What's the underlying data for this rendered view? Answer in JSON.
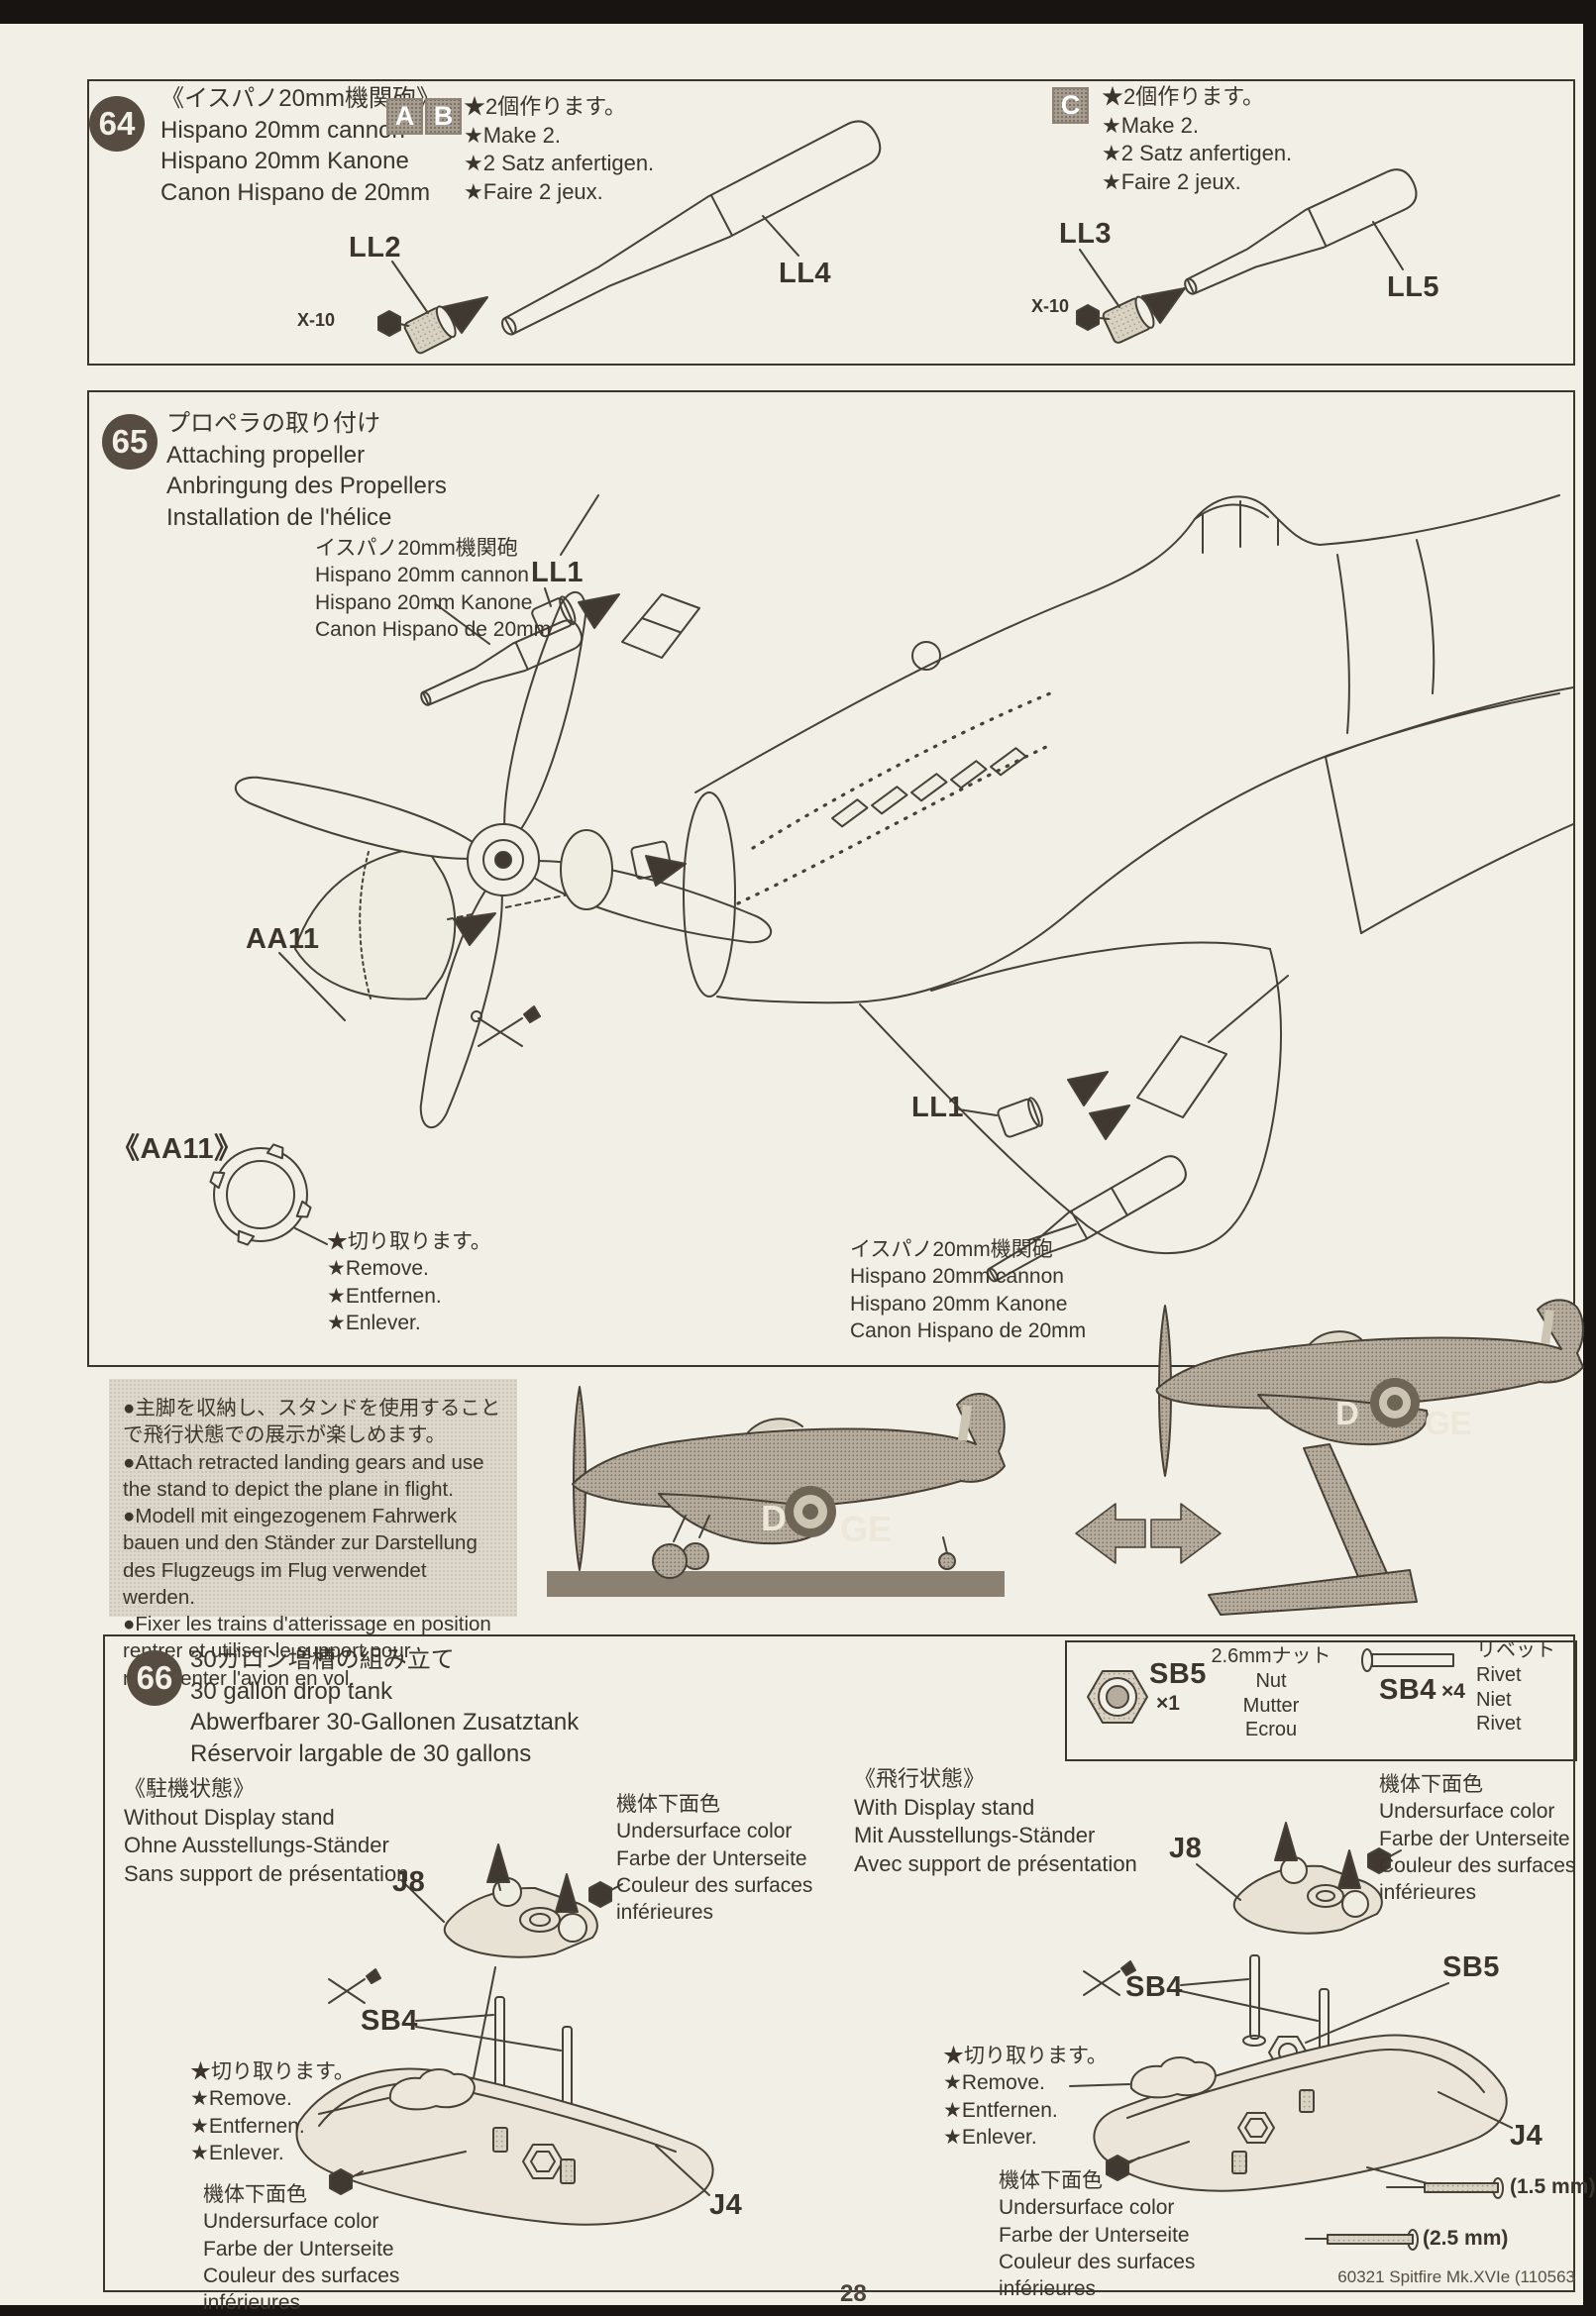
{
  "page": {
    "number": "28",
    "footer": "60321 Spitfire Mk.XVIe (110563"
  },
  "colors": {
    "paper": "#f2efe6",
    "ink": "#3b352c",
    "badge": "#564c42",
    "halftone": "#b6ad9e"
  },
  "markings": {
    "d": "D",
    "ge": "GE"
  },
  "note_box": "●主脚を収納し、スタンドを使用することで飛行状態での展示が楽しめます。\n●Attach retracted landing gears and use the stand to depict the plane in flight.\n●Modell mit eingezogenem Fahrwerk bauen und den Ständer zur Darstellung des Flugzeugs im Flug verwendet werden.\n●Fixer les trains d'atterissage en position rentrer et utiliser le support pour représenter l'avion en vol.",
  "steps": {
    "s64": {
      "num": "64",
      "title": "《イスパノ20mm機関砲》\nHispano 20mm cannon\nHispano 20mm Kanone\nCanon Hispano de 20mm",
      "variants_ab": [
        "A",
        "B"
      ],
      "variant_c": "C",
      "make_two": "★2個作ります。\n★Make 2.\n★2 Satz anfertigen.\n★Faire 2 jeux.",
      "labels": {
        "ll2": "LL2",
        "ll3": "LL3",
        "ll4": "LL4",
        "ll5": "LL5",
        "x10": "X-10"
      }
    },
    "s65": {
      "num": "65",
      "title": "プロペラの取り付け\nAttaching propeller\nAnbringung des Propellers\nInstallation de l'hélice",
      "cannon_note": "イスパノ20mm機関砲\nHispano 20mm cannon\nHispano 20mm Kanone\nCanon Hispano de 20mm",
      "remove_note": "★切り取ります。\n★Remove.\n★Entfernen.\n★Enlever.",
      "labels": {
        "ll1": "LL1",
        "aa11": "AA11",
        "aa11_bracket": "《AA11》"
      }
    },
    "s66": {
      "num": "66",
      "title": "30ガロン増槽の組み立て\n30 gallon drop tank\nAbwerfbarer 30-Gallonen Zusatztank\nRéservoir largable de 30 gallons",
      "parts_box": {
        "sb5_code": "SB5",
        "sb5_qty": "×1",
        "sb5_name": "2.6mmナット\nNut\nMutter\nEcrou",
        "sb4_code": "SB4",
        "sb4_qty": "×4",
        "sb4_name": "リベット\nRivet\nNiet\nRivet"
      },
      "without_stand": "《駐機状態》\nWithout Display stand\nOhne Ausstellungs-Ständer\nSans support de présentation",
      "with_stand": "《飛行状態》\nWith Display stand\nMit Ausstellungs-Ständer\nAvec support de présentation",
      "undersurface": "機体下面色\nUndersurface color\nFarbe der Unterseite\nCouleur des surfaces\ninférieures",
      "remove_note": "★切り取ります。\n★Remove.\n★Entfernen.\n★Enlever.",
      "labels": {
        "j8": "J8",
        "j4": "J4",
        "sb4": "SB4",
        "sb5": "SB5"
      },
      "sizes": {
        "s15": "(1.5 mm)",
        "s25": "(2.5 mm)"
      }
    }
  }
}
